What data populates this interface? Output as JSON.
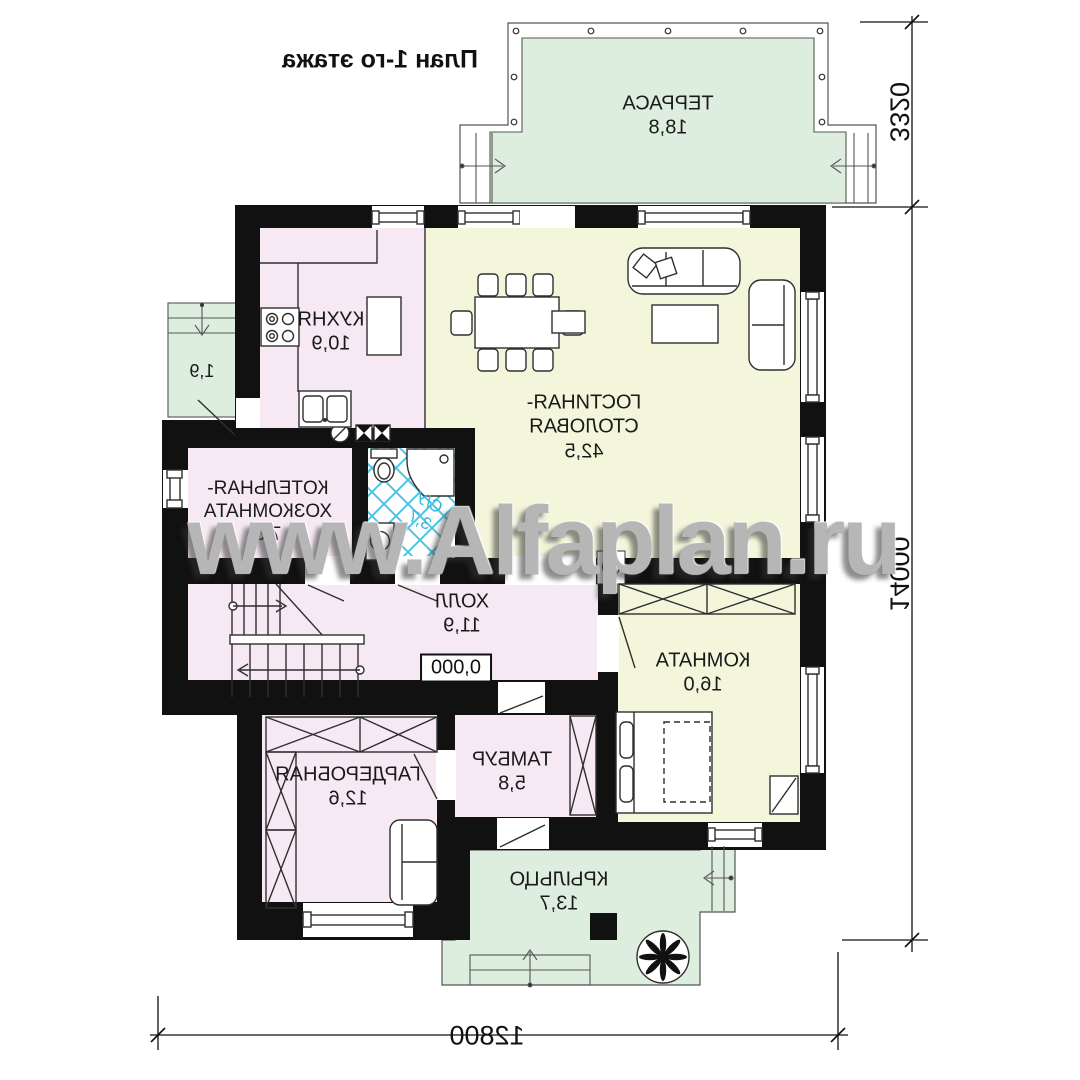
{
  "title": "План 1-го этажа",
  "watermark": "www.Alfaplan.ru",
  "rooms": {
    "terrace": {
      "name": "ТЕРРАСА",
      "area": "18,8"
    },
    "kitchen": {
      "name": "КУХНЯ",
      "area": "10,9"
    },
    "living": {
      "name_line1": "ГОСТИНАЯ-",
      "name_line2": "СТОЛОВАЯ",
      "area": "42,5"
    },
    "boiler": {
      "name_line1": "КОТЕЛЬНАЯ-",
      "name_line2": "ХОЗКОМНАТА",
      "area": "7,3"
    },
    "bathroom": {
      "name": "С/У",
      "area": "3,7"
    },
    "hall": {
      "name": "ХОЛЛ",
      "area": "11,9"
    },
    "room": {
      "name": "КОМНАТА",
      "area": "16,0"
    },
    "tambour": {
      "name": "ТАМБУР",
      "area": "5,8"
    },
    "wardrobe_room": {
      "name": "ГАРДЕРОБНАЯ",
      "area": "12,6"
    },
    "porch": {
      "name": "КРЫЛЬЦО",
      "area": "13,7"
    },
    "side_entry": {
      "area": "1,9"
    }
  },
  "elevation_mark": "0,000",
  "dimensions": {
    "terrace_depth": "3320",
    "house_length": "14000",
    "house_width": "12800"
  },
  "colors": {
    "wall": "#111111",
    "floor_pink": "#f6e9f3",
    "floor_yellow": "#f4f6dc",
    "floor_green": "#deeede",
    "tile_blue": "#4cc5e4",
    "bath_label_blue": "#2fb6da",
    "watermark_gray": "#b6b6b6"
  }
}
